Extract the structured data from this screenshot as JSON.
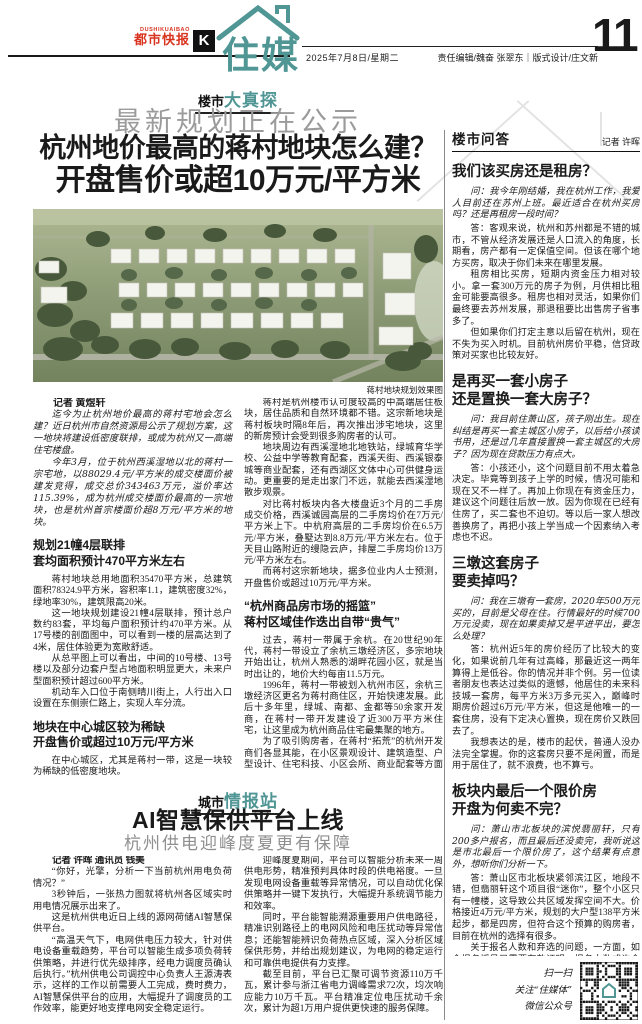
{
  "colors": {
    "teal": "#4f9694",
    "brand_red": "#d9341f"
  },
  "masthead": {
    "brand_en": "DUSHIKUAIBAO",
    "brand_cn": "都市快报",
    "k_logo": "K",
    "section_logo": "住媒",
    "date": "2025年7月8日/星期二",
    "editors": "责任编辑/魏奋 张翠东｜版式设计/庄文新",
    "page_number": "11"
  },
  "main_article": {
    "tag_black": "楼市",
    "tag_teal": "大真探",
    "kicker": "最新规划正在公示",
    "headline_line1": "杭州地价最高的蒋村地块怎么建？",
    "headline_line2": "开盘售价或超10万元/平方米",
    "photo_caption": "蒋村地块规划效果图",
    "byline": "记者 黄煜轩",
    "intro_1": "迄今为止杭州地价最高的蒋村宅地会怎么建？近日杭州市自然资源局公示了规划方案，这一地块将建设低密度联排，或成为杭州又一高端住宅楼盘。",
    "intro_2": "今年3月，位于杭州西溪湿地以北的蒋村一宗宅地，以88029.4元/平方米的成交楼面价被建发竞得，成交总价343463万元，溢价率达115.39%，成为杭州成交楼面价最高的一宗地块，也是杭州首宗楼面价超8万元/平方米的地块。",
    "sec1_head1": "规划21幢4层联排",
    "sec1_head2": "套均面积预计470平方米左右",
    "sec1_p1": "蒋村地块总用地面积35470平方米，总建筑面积78324.9平方米，容积率1.1，建筑密度32%，绿地率30%，建筑限高20米。",
    "sec1_p2": "这一地块规划建设21幢4层联排，预计总户数约83套，平均每户面积预计约470平方米。从17号楼的剖面图中，可以看到一楼的层高达到了4米，居住体验更为宽敞舒适。",
    "sec1_p3": "从总平图上可以看出，中间的10号楼、13号楼以及部分边套户型占地面积明显更大，未来户型面积预计超过600平方米。",
    "sec1_p4": "机动车入口位于南侧晴川街上，人行出入口设置在东侧崇仁路上，实现人车分流。",
    "sec2_head1": "地块在中心城区较为稀缺",
    "sec2_head2": "开盘售价或超过10万元/平方米",
    "sec2_p1": "在中心城区，尤其是蒋村一带，这是一块较为稀缺的低密度地块。",
    "sec2_p2": "蒋村是杭州楼市认可度较高的中高端居住板块，居住品质和自然环境都不错。这宗新地块是蒋村板块时隔8年后，再次推出涉宅地块，这里的新房预计会受到很多购房者的认可。",
    "sec2_p3": "地块周边有西溪湿地北地铁站，绿城育华学校、公益中学等教育配套，西溪天街、西溪银泰城等商业配套，还有西湖区文体中心可供健身运动。更重要的是走出家门不远，就能去西溪湿地散步观景。",
    "sec2_p4": "对比蒋村板块内各大楼盘近3个月的二手房成交价格，西溪诚园高层的二手房均价在7万元/平方米上下。中杭府高层的二手房均价在6.5万元/平方米，叠墅达到8.8万元/平方米左右。位于天目山路附近的缦隐云庐，排屋二手房均价13万元/平方米左右。",
    "sec2_p5": "而蒋村这宗新地块，据多位业内人士预测，开盘售价或超过10万元/平方米。",
    "sec3_head1": "“杭州商品房市场的摇篮”",
    "sec3_head2": "蒋村区域佳作迭出自带“贵气”",
    "sec3_p1": "过去，蒋村一带属于余杭。在20世纪90年代，蒋村一带设立了余杭三墩经济区，多宗地块开始出让，杭州人熟悉的湖畔花园小区，就是当时出让的，地价大约每亩11.5万元。",
    "sec3_p2": "1996年，蒋村一带被划入杭州市区，余杭三墩经济区更名为蒋村商住区，开始快速发展。此后十多年里，绿城、南都、金都等50余家开发商，在蒋村一带开发建设了近300万平方米住宅，让这里成为杭州商品住宅最集聚的地方。",
    "sec3_p3": "为了吸引购房者，在蒋村“拓荒”的杭州开发商们各显其能，在小区景观设计、建筑造型、户型设计、住宅科技、小区会所、商业配套等方面不断创新，推动了杭州城市居住品质的提升，也让蒋村区域自带“贵气”。",
    "sec3_p4": "因此，很多人把蒋村一带视为“杭州商品房市场的摇篮”。",
    "sec3_p5": "随着城市的发展，西溪湿地陆续进行保护开发。在西溪湿地以北区域，开发建设了多个中高端住宅楼盘，如西溪诚园、西溪蝶园等。利用西溪湿地的自然环境优势，这里的居民拥有舒适的居住环境、优质的居住体验，这一带也逐渐成为杭州的中高端居住区。"
  },
  "qa": {
    "section_title": "楼市问答",
    "byline": "记者 许晖",
    "q1_head": "我们该买房还是租房？",
    "q1_ask": "问：我今年刚结婚，我在杭州工作，我爱人目前还在苏州上班。最近适合在杭州买房吗？还是再租房一段时间？",
    "q1_a1": "答：客观来说，杭州和苏州都是不错的城市，不管从经济发展还是人口流入的角度，长期看，房产都有一定保值空间。但该在哪个地方买房，取决于你们未来在哪里发展。",
    "q1_a2": "租房相比买房，短期内资金压力相对较小。拿一套300万元的房子为例，月供相比租金可能要高很多。租房也相对灵活，如果你们最终要去苏州发展，那退租要比出售房子省事多了。",
    "q1_a3": "但如果你们打定主意以后留在杭州，现在不失为买入时机。目前杭州房价平稳，信贷政策对买家也比较友好。",
    "q2_head1": "是再买一套小房子",
    "q2_head2": "还是置换一套大房子？",
    "q2_ask": "问：我目前住萧山区，孩子刚出生。现在纠结是再买一套主城区小房子，以后给小孩读书用，还是过几年直接置换一套主城区的大房子？因为现在贷款压力有点大。",
    "q2_a1": "答：小孩还小，这个问题目前不用太着急决定。毕竟等到孩子上学的时候，情况可能和现在又不一样了。再加上你现在有资金压力，建议这个问题往后放一放。因为你现在已经有住房了，买二套也不迫切。等以后一家人想改善换房了，再把小孩上学当成一个因素纳入考虑也不迟。",
    "q3_head1": "三墩这套房子",
    "q3_head2": "要卖掉吗？",
    "q3_ask": "问：我在三墩有一套房，2020年500万元买的，目前是父母在住。行情最好的时候700万元没卖，现在如果卖掉又是平进平出，要怎么处理？",
    "q3_a1": "答：杭州近5年的房价经历了比较大的变化，如果说前几年有过高峰，那最近这一两年算得上是低谷。你的情况并非个例。另一位读者朋友也表达过类似的遗憾，他居住的未来科技城一套房，每平方米3万多元买入，巅峰时期房价超过6万元/平方米，但这是他唯一的一套住房，没有下定决心置换，现在房价又跌回去了。",
    "q3_a2": "我想表达的是，楼市的起伏，普通人没办法完全掌握。你的这套房只要不是闲置，而是用于居住了，就不浪费，也不算亏。",
    "q4_head1": "板块内最后一个限价房",
    "q4_head2": "开盘为何卖不完？",
    "q4_ask": "问：萧山市北板块的滨悦翡丽轩，只有200多户报名，而且最后还没卖完，我听说这是市北最后一个限价房了，这个结果有点意外，想听你们分析一下。",
    "q4_a1": "答：萧山区市北板块紧邻滨江区，地段不错，但翡丽轩这个项目很“迷你”，整个小区只有一幢楼，这导致公共区域发挥空间不大。价格接近4万元/平方米，规划的大户型138平方米起步，都是四房，但符合这个预算的购房者，目前在杭州的选择有很多。",
    "q4_a2": "关于报名人数和弃选的问题，一方面，如今报名摇号只需要存款证明，报名人数或许会有水分；另一方面，那些号码靠后，选不到心仪楼层和户型的购房者，弃选也是理所当然的。",
    "q4_a3": "销售情况和是否限价其实无关。这个楼盘的开发商也不算知名，可能有很多购房者并不知道这个楼盘。再加上市北板块内有多个新房，二手房挂牌量也不少，竞品云集的情况下，卖不完应该属于正常现象。",
    "qr_line1": "扫一扫",
    "qr_line2": "关注“住媒体”",
    "qr_line3": "微信公众号"
  },
  "power_article": {
    "tag_black": "城市",
    "tag_teal": "情报站",
    "headline": "AI智慧保供平台上线",
    "subheadline": "杭州供电迎峰度夏更有保障",
    "byline": "记者 许晖 通讯员 钱美",
    "p1": "“你好，光擎，分析一下当前杭州用电负荷情况？”",
    "p2": "3秒钟后，一张热力图就将杭州各区域实时用电情况展示出来了。",
    "p3": "这是杭州供电近日上线的源网荷储AI智慧保供平台。",
    "p4": "“高温天气下，电网供电压力较大，针对供电设备重载趋势，平台可以智能生成多项负荷转供策略，并进行优先级排序，经电力调度员确认后执行。”杭州供电公司调控中心负责人王源涛表示，这样的工作以前需要人工完成，费时费力，AI智慧保供平台的应用，大幅提升了调度员的工作效率，能更好地支撑电网安全稳定运行。",
    "p5": "迎峰度夏期间，平台可以智能分析未来一周供电形势，精准预判具体时段的供电裕度。一旦发现电网设备重载等异常情况，可以自动优化保供策略并一键下发执行，大幅提升系统调节能力和效率。",
    "p6": "同时，平台能智能溯源重要用户供电路径，精准识别路径上的电网风险和电压扰动等异常信息；还能智能辨识负荷热点区域，深入分析区域保供形势，并给出规划建议，为电网的稳定运行和可靠供电提供有力支撑。",
    "p7": "截至目前，平台已汇聚可调节资源110万千瓦，累计参与浙江省电力调峰需求72次，均次响应能力10万千瓦。平台精准定位电压扰动千余次，累计为超1万用户提供更快速的服务保障。"
  }
}
